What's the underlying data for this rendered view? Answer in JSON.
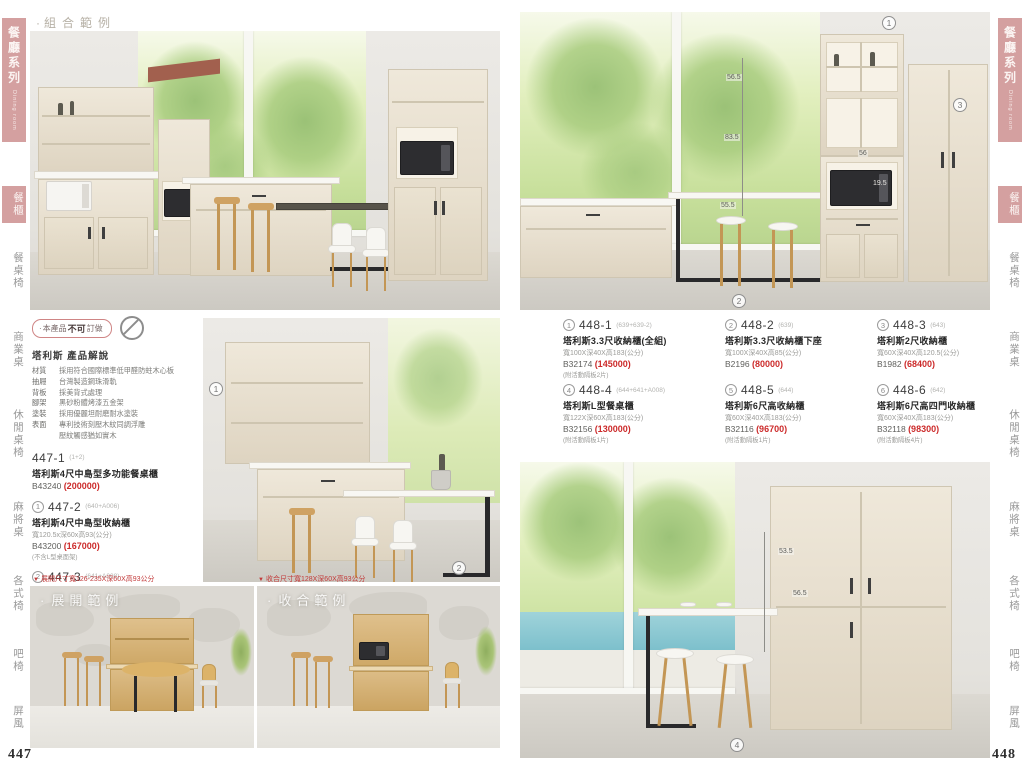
{
  "pages": {
    "left": "447",
    "right": "448"
  },
  "colors": {
    "accent_pink": "#d4a0a0",
    "price_red": "#cc2a2a"
  },
  "icons": {
    "triangle_down": "▼",
    "dot": "·"
  },
  "sidebar": {
    "series": "餐廳系列",
    "series_en": "Dining room",
    "category_active": "餐櫃",
    "categories": [
      "餐桌椅",
      "商業桌",
      "休閒桌椅",
      "麻將桌",
      "各式椅",
      "吧椅",
      "屏風"
    ]
  },
  "left_page": {
    "combo_title": "組合範例",
    "notice_prefix": "本產品",
    "notice_bold": "不可",
    "notice_suffix": "訂做",
    "intro_title": "塔利斯 產品解說",
    "specs": [
      {
        "label": "材質",
        "text": "採用符合國際標準低甲醛防蛀木心板"
      },
      {
        "label": "抽屜",
        "text": "台灣製造鋼珠滑軌"
      },
      {
        "label": "背板",
        "text": "採美背式處理"
      },
      {
        "label": "腳架",
        "text": "黑砂粉體烤漆五金架"
      },
      {
        "label": "塗裝",
        "text": "採用優麗坦耐磨耐水塗裝"
      },
      {
        "label": "表面",
        "text": "專利技術刻壓木紋同調浮雕"
      },
      {
        "label": "",
        "text": "壓紋觸感猶如實木"
      }
    ],
    "products": [
      {
        "marker": "",
        "code": "447-1",
        "ref": "(1+2)",
        "name": "塔利斯4尺中島型多功能餐桌櫃",
        "size": "",
        "sku": "B43240",
        "price": "(200000)",
        "note": ""
      },
      {
        "marker": "1",
        "code": "447-2",
        "ref": "(640+A006)",
        "name": "塔利斯4尺中島型收納櫃",
        "size": "寬120.5x深60x高93(公分)",
        "sku": "B43200",
        "price": "(167000)",
        "note": "(不含L型桌面架)"
      },
      {
        "marker": "2",
        "code": "447-3",
        "ref": "(641+A008)",
        "name": "塔利斯L型桌面架",
        "size": "寬121x深53x高75.5(公分)",
        "sku": "B6540",
        "price": "(33400)",
        "note": ""
      }
    ],
    "dim_expanded": "展開尺寸寬126-235X深60X高93公分",
    "dim_collapsed": "收合尺寸寬128X深60X高93公分",
    "expanded_photo_title": "展開範例",
    "collapsed_photo_title": "收合範例",
    "middle_photo_markers": [
      "1",
      "2"
    ]
  },
  "right_page": {
    "products": [
      {
        "marker": "1",
        "code": "448-1",
        "ref": "(639+639-2)",
        "name": "塔利斯3.3尺收納櫃(全組)",
        "size": "寬100X深40X高183(公分)",
        "sku": "B32174",
        "price": "(145000)",
        "note": "(附活動隔板2片)"
      },
      {
        "marker": "2",
        "code": "448-2",
        "ref": "(639)",
        "name": "塔利斯3.3尺收納櫃下座",
        "size": "寬100X深40X高85(公分)",
        "sku": "B2196",
        "price": "(80000)",
        "note": ""
      },
      {
        "marker": "3",
        "code": "448-3",
        "ref": "(643)",
        "name": "塔利斯2尺收納櫃",
        "size": "寬60X深40X高120.5(公分)",
        "sku": "B1982",
        "price": "(68400)",
        "note": ""
      },
      {
        "marker": "4",
        "code": "448-4",
        "ref": "(644+641+A008)",
        "name": "塔利斯L型餐桌櫃",
        "size": "寬122X深60X高183(公分)",
        "sku": "B32156",
        "price": "(130000)",
        "note": "(附活動隔板1片)"
      },
      {
        "marker": "5",
        "code": "448-5",
        "ref": "(644)",
        "name": "塔利斯6尺高收納櫃",
        "size": "寬60X深40X高183(公分)",
        "sku": "B32116",
        "price": "(96700)",
        "note": "(附活動隔板1片)"
      },
      {
        "marker": "6",
        "code": "448-6",
        "ref": "(642)",
        "name": "塔利斯6尺高四門收納櫃",
        "size": "寬60X深40X高183(公分)",
        "sku": "B32118",
        "price": "(98300)",
        "note": "(附活動隔板4片)"
      }
    ],
    "top_photo_markers": [
      "1",
      "3",
      "2"
    ],
    "top_photo_measurements": [
      "56.5",
      "83.5",
      "55.5",
      "56",
      "19.5"
    ],
    "bottom_photo_markers": [
      "4"
    ],
    "bottom_photo_measurements": [
      "53.5",
      "56.5"
    ]
  }
}
